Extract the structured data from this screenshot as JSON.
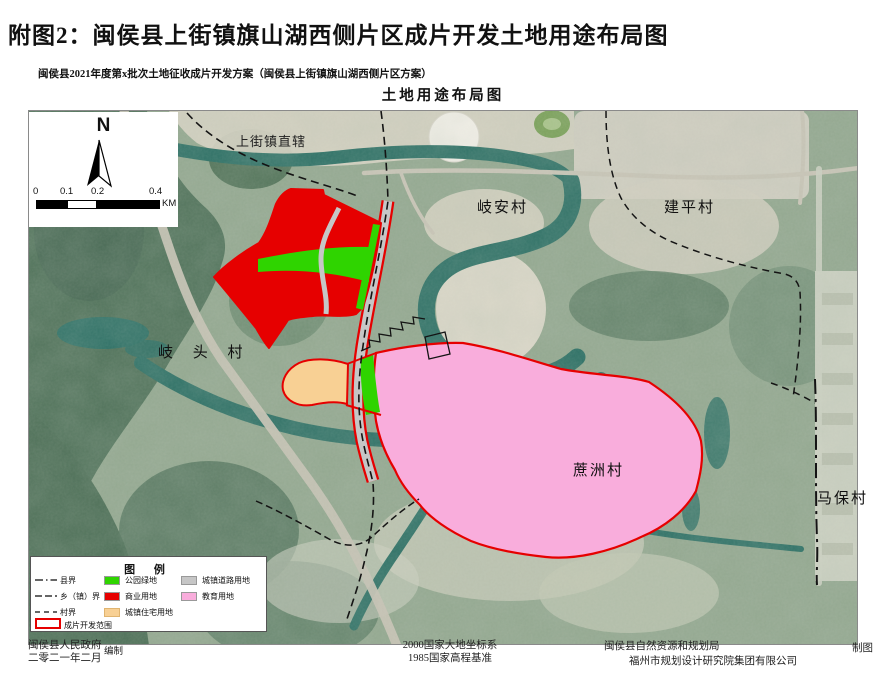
{
  "header": {
    "title": "附图2：闽侯县上街镇旗山湖西侧片区成片开发土地用途布局图",
    "subtitle": "闽侯县2021年度第x批次土地征收成片开发方案（闽侯县上街镇旗山湖西侧片区方案）",
    "map_title": "土地用途布局图"
  },
  "map": {
    "compass": {
      "north_label": "N"
    },
    "scalebar": {
      "ticks": [
        "0",
        "0.1",
        "0.2",
        "0.4"
      ],
      "unit": "KM"
    },
    "labels": {
      "shangjie": "上街镇直辖",
      "qian_village": "岐安村",
      "jianping_village": "建平村",
      "qitou_village": "岐 头 村",
      "zhezhou_village": "蔗洲村",
      "mabao_village": "马保村"
    }
  },
  "legend": {
    "title": "图  例",
    "boundary_items": [
      {
        "label": "县界",
        "style": "dash-dot"
      },
      {
        "label": "乡（镇）界",
        "style": "long-dash"
      },
      {
        "label": "村界",
        "style": "dash"
      },
      {
        "label": "成片开发范围",
        "style": "red-outline",
        "color": "#e60000"
      }
    ],
    "landuse_items": [
      {
        "label": "公园绿地",
        "color": "#2fd400"
      },
      {
        "label": "商业用地",
        "color": "#e60000"
      },
      {
        "label": "城镇住宅用地",
        "color": "#f8d094"
      },
      {
        "label": "城镇道路用地",
        "color": "#c6c6c6"
      },
      {
        "label": "教育用地",
        "color": "#f9addc"
      }
    ]
  },
  "footer": {
    "compiler_org": "闽侯县人民政府",
    "compiler_date": "二零二一年二月",
    "compiler_role": "编制",
    "datum_line1": "2000国家大地坐标系",
    "datum_line2": "1985国家高程基准",
    "mapping_org1": "闽侯县自然资源和规划局",
    "mapping_role": "制图",
    "mapping_org2": "福州市规划设计研究院集团有限公司"
  },
  "colors": {
    "water": "#2d7065",
    "forest": "#50725a",
    "urban": "#d7d2c3",
    "zone_outline_red": "#e60000"
  }
}
